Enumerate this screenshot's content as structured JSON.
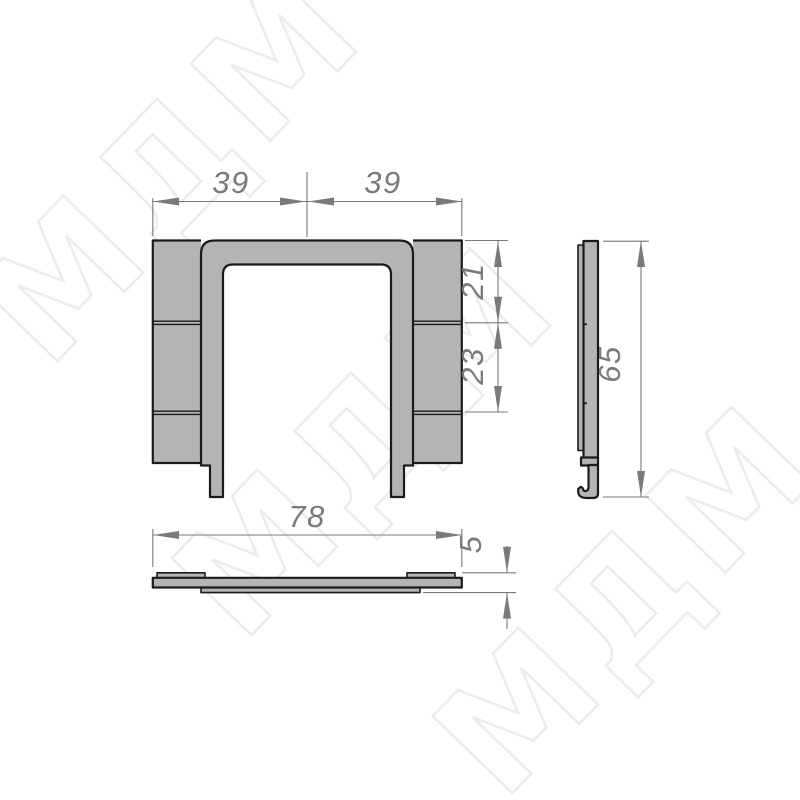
{
  "colors": {
    "background": "#ffffff",
    "part_fill": "#b4b4b4",
    "part_outline": "#1b1b1b",
    "dim_color": "#7a7a7a",
    "watermark_stroke": "#dcdcdc"
  },
  "watermark": {
    "text": "МДМ"
  },
  "dimensions": {
    "front_top_left": "39",
    "front_top_right": "39",
    "front_side_upper": "21",
    "front_side_lower": "23",
    "side_height": "65",
    "bottom_width": "78",
    "bottom_thickness": "5"
  }
}
